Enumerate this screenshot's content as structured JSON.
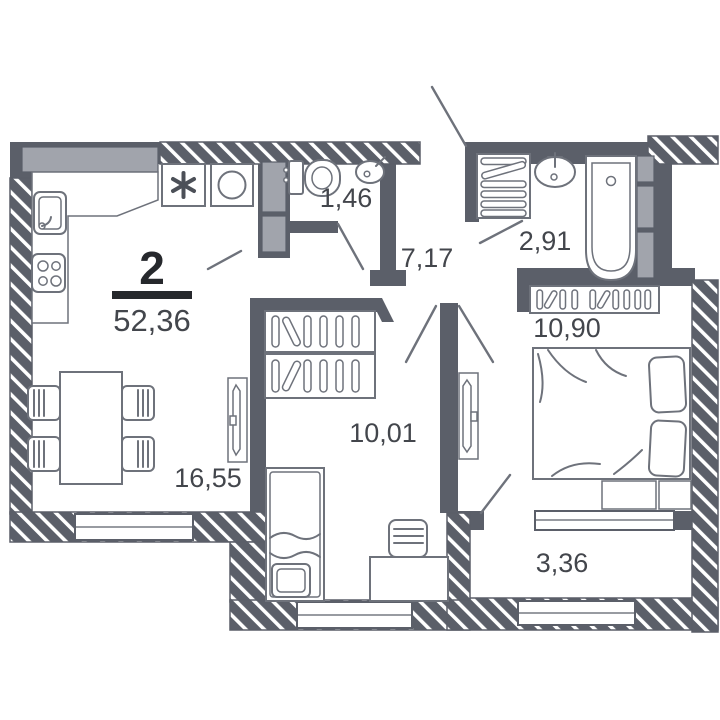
{
  "apartment": {
    "rooms_count": "2",
    "total_area": "52,36"
  },
  "room_areas": {
    "wc": "1,46",
    "hallway": "7,17",
    "bathroom": "2,91",
    "bedroom": "10,90",
    "kitchen_living_room": "16,55",
    "bedroom_2": "10,01",
    "balcony": "3,36"
  },
  "colors": {
    "wall": "#5b5f69",
    "light_fill": "#a1a4ac",
    "fixture_line": "#6e727b",
    "label_text": "#43464c",
    "accent_text": "#26282c",
    "background": "#ffffff"
  }
}
